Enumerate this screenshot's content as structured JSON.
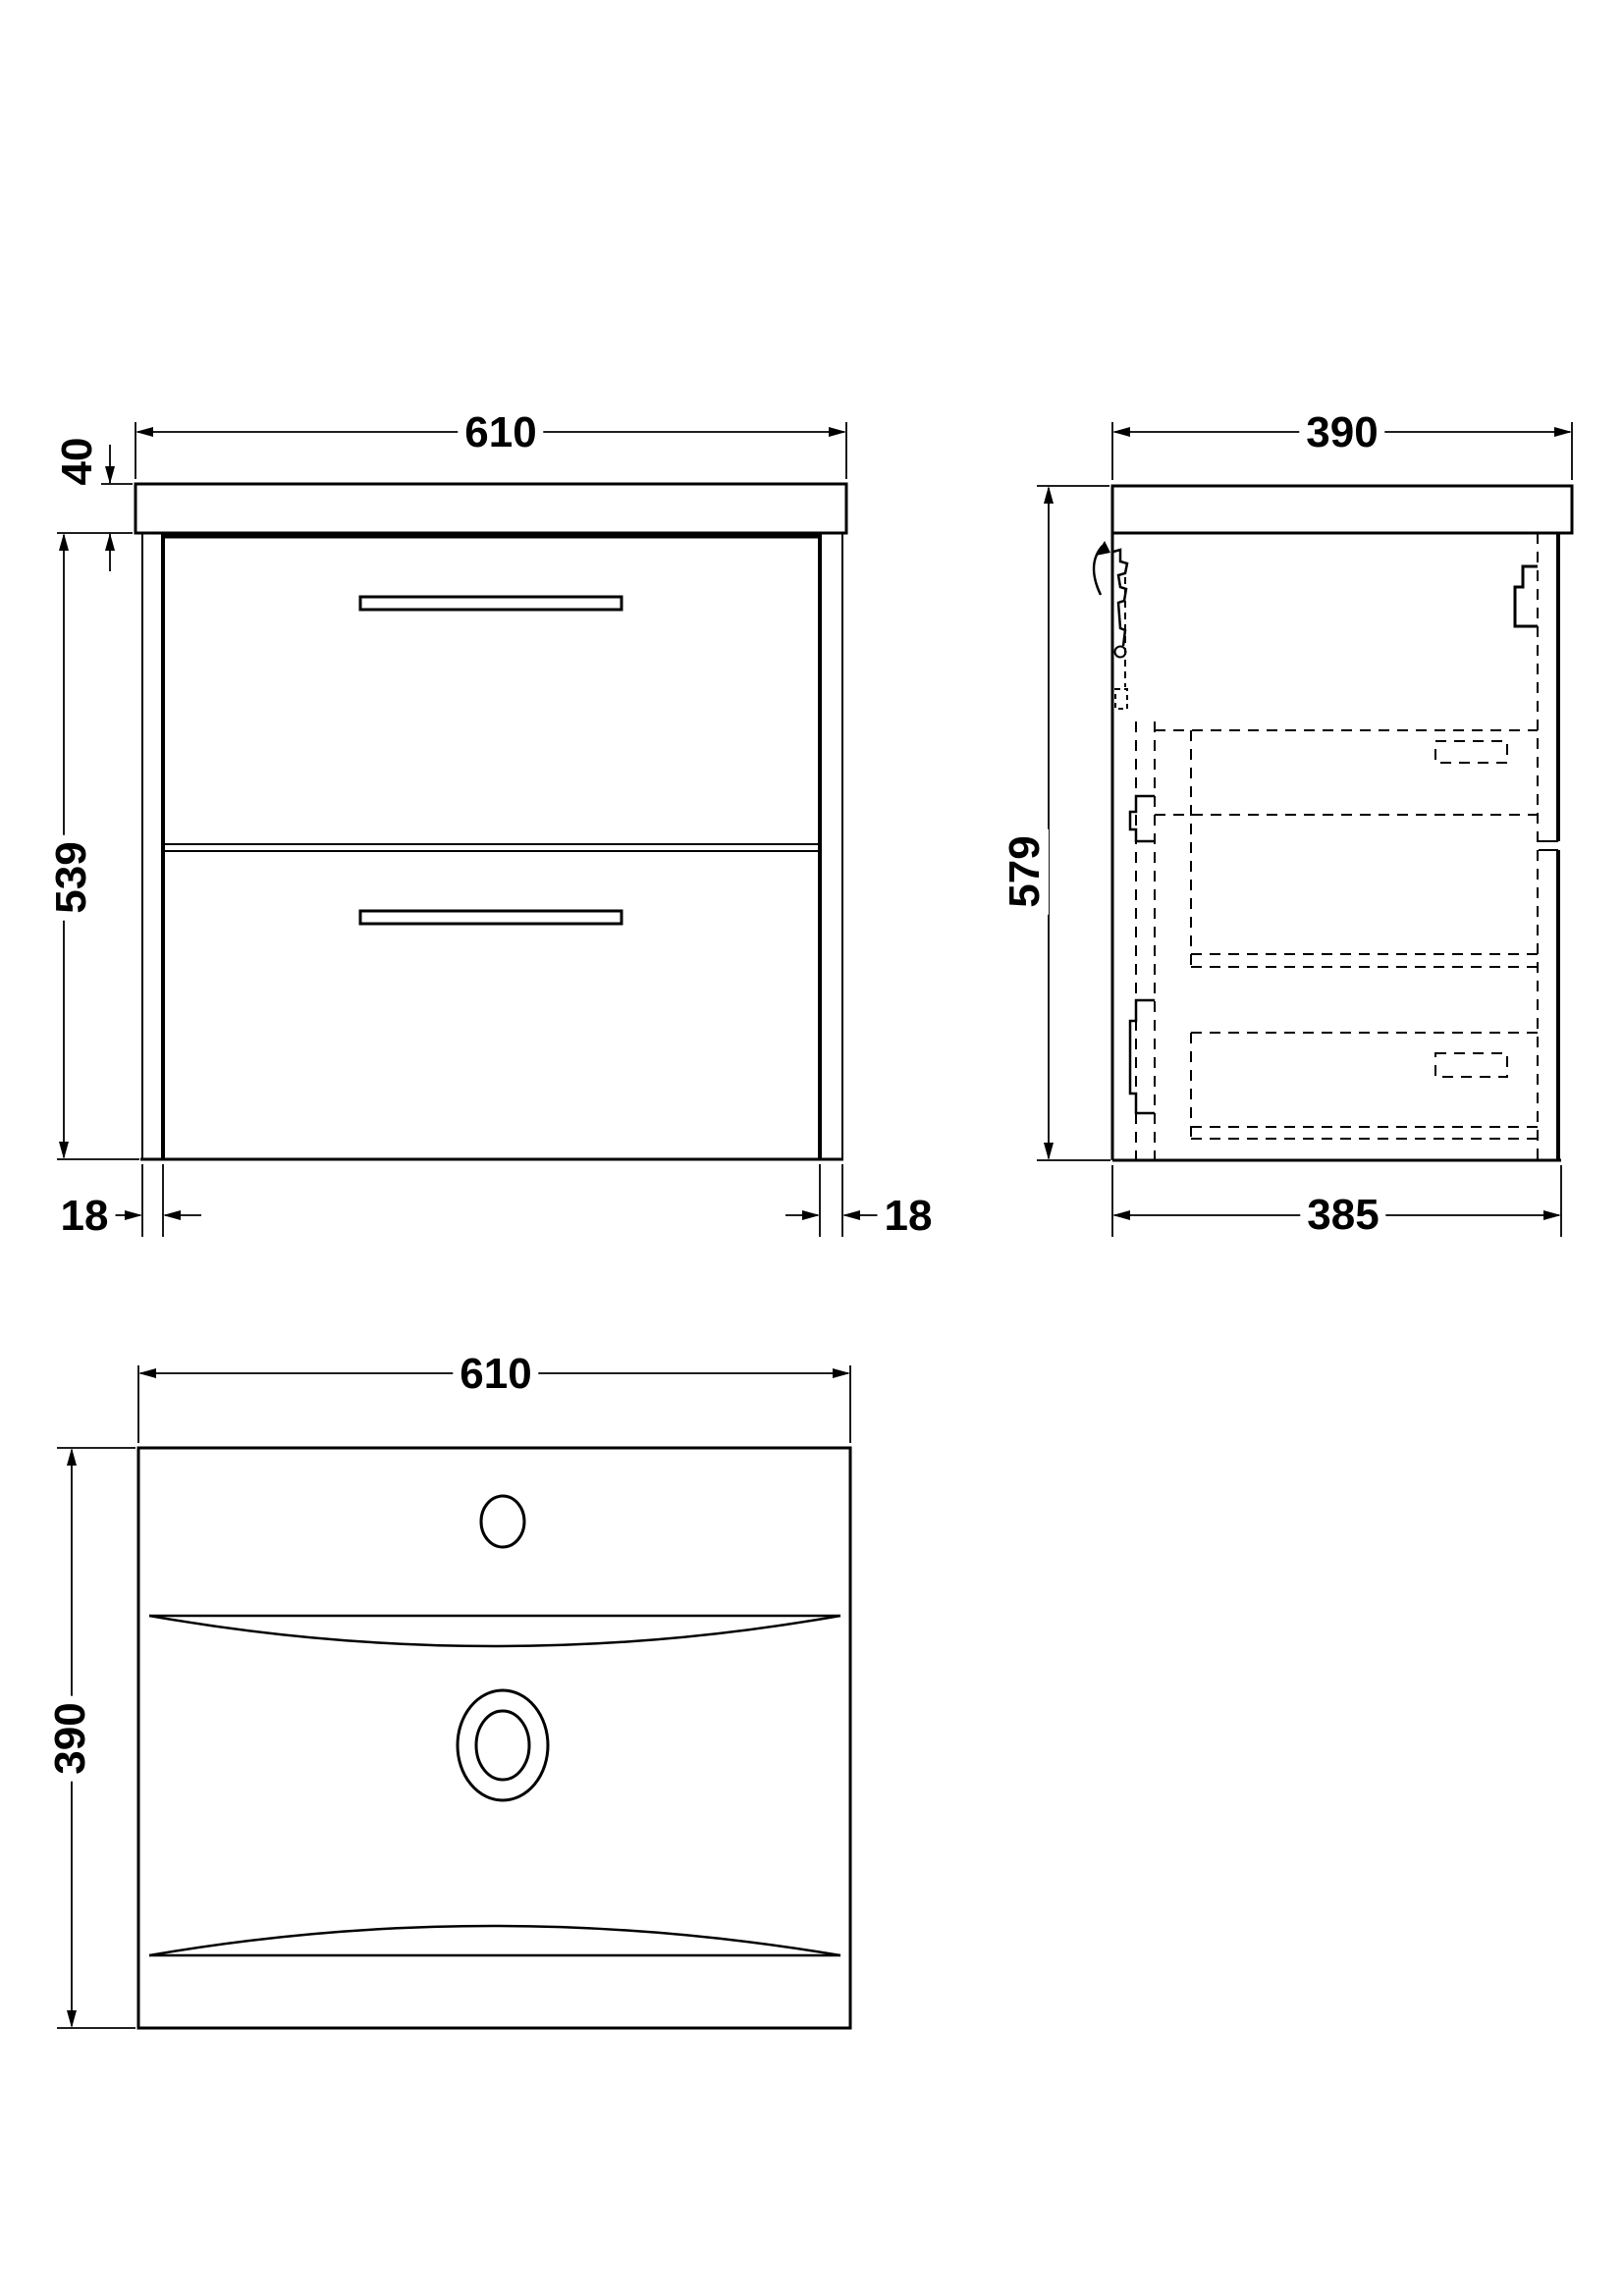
{
  "title": "Wall-hung vanity unit technical drawing",
  "views": {
    "front": {
      "name": "front-elevation",
      "dims": {
        "width": {
          "value": 610,
          "label": "610",
          "unit": "mm"
        },
        "worktop_thickness": {
          "value": 40,
          "label": "40",
          "unit": "mm"
        },
        "cabinet_height": {
          "value": 539,
          "label": "539",
          "unit": "mm"
        },
        "left_panel": {
          "value": 18,
          "label": "18",
          "unit": "mm"
        },
        "right_panel": {
          "value": 18,
          "label": "18",
          "unit": "mm"
        }
      },
      "features": [
        "worktop",
        "two-drawers",
        "two-centered-handles",
        "side-end-panels"
      ]
    },
    "side": {
      "name": "side-elevation",
      "dims": {
        "worktop_depth": {
          "value": 390,
          "label": "390",
          "unit": "mm"
        },
        "overall_height": {
          "value": 579,
          "label": "579",
          "unit": "mm"
        },
        "cabinet_depth": {
          "value": 385,
          "label": "385",
          "unit": "mm"
        }
      },
      "features": [
        "wall-hanging-bracket",
        "hidden-drawer-boxes-dashed",
        "drawer-front-split"
      ]
    },
    "plan": {
      "name": "basin-plan",
      "dims": {
        "width": {
          "value": 610,
          "label": "610",
          "unit": "mm"
        },
        "depth": {
          "value": 390,
          "label": "390",
          "unit": "mm"
        }
      },
      "features": [
        "tap-hole",
        "overflow-waste-rings",
        "front-and-back-bowl-curves"
      ]
    }
  },
  "style": {
    "line_color": "#000000",
    "background": "#ffffff"
  }
}
